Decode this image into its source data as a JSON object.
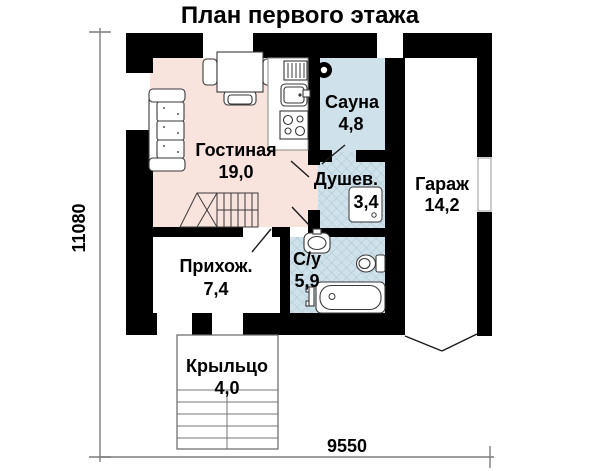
{
  "title": "План первого этажа",
  "dimensions": {
    "vertical": "11080",
    "horizontal": "9550"
  },
  "rooms": {
    "living": {
      "name": "Гостиная",
      "area": "19,0"
    },
    "sauna": {
      "name": "Сауна",
      "area": "4,8"
    },
    "shower": {
      "name": "Душев.",
      "area": "3,4"
    },
    "garage": {
      "name": "Гараж",
      "area": "14,2"
    },
    "hallway": {
      "name": "Прихож.",
      "area": "7,4"
    },
    "bathroom": {
      "name": "С/у",
      "area": "5,9"
    },
    "porch": {
      "name": "Крыльцо",
      "area": "4,0"
    }
  },
  "colors": {
    "wall": "#000000",
    "living_fill": "#f9e3dd",
    "wet_fill": "#cfe2ec",
    "hatch_line": "#a9c2cf",
    "dimension_line": "#7d7d7d"
  },
  "icons": [
    "sofa-icon",
    "dining-table-icon",
    "fridge-icon",
    "kitchen-sink-icon",
    "stove-icon",
    "sauna-stove-icon",
    "shower-tray-icon",
    "washbasin-icon",
    "toilet-icon",
    "bathtub-icon",
    "stairs-icon",
    "porch-steps-icon"
  ]
}
